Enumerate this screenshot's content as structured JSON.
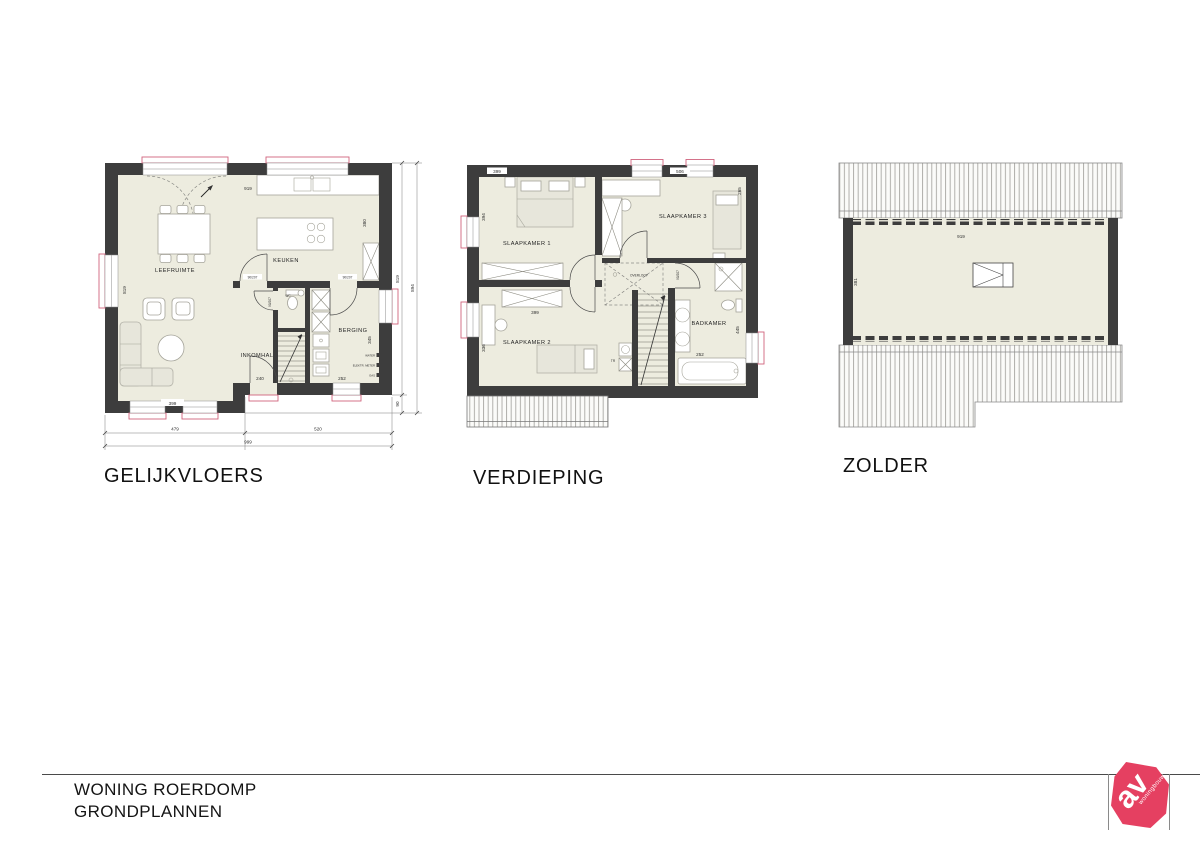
{
  "title_block": {
    "line1": "WONING ROERDOMP",
    "line2": "GRONDPLANNEN"
  },
  "logo": {
    "initials": "av",
    "subtext": "woningbouw",
    "color": "#e54061"
  },
  "gelijkvloers": {
    "title": "GELIJKVLOERS",
    "rooms": {
      "living": "LEEFRUIMTE",
      "kitchen": "KEUKEN",
      "hall": "INKOMHAL",
      "storage": "BERGING",
      "wc": "WC"
    },
    "door_labels": {
      "a": "90/207",
      "b": "90/207",
      "c": "90/207"
    },
    "meter_labels": {
      "water": "WATER",
      "electric": "ELEKTR. METER",
      "gas": "GAS"
    },
    "dims": {
      "top_width": "919",
      "left_height": "819",
      "kitchen_depth": "380",
      "storage_height": "345",
      "living_width": "399",
      "hall_width": "240",
      "storage_width": "252",
      "bottom_left": "479",
      "bottom_right": "520",
      "bottom_total": "999",
      "right_inner": "819",
      "right_outer": "894",
      "right_offset": "90"
    }
  },
  "verdieping": {
    "title": "VERDIEPING",
    "rooms": {
      "bedroom1": "SLAAPKAMER 1",
      "bedroom2": "SLAAPKAMER 2",
      "bedroom3": "SLAAPKAMER 3",
      "bathroom": "BADKAMER",
      "landing": "OVERLOOP",
      "stair": "TR"
    },
    "door_labels": {
      "a": "90/207"
    },
    "dims": {
      "bedroom1_width": "399",
      "bedroom1_height": "394",
      "bedroom3_width": "506",
      "bedroom3_height": "265",
      "bedroom2_width": "399",
      "bedroom2_height": "336",
      "bathroom_width": "252",
      "bathroom_height": "445"
    }
  },
  "zolder": {
    "title": "ZOLDER",
    "dims": {
      "width": "919",
      "depth": "381"
    }
  }
}
